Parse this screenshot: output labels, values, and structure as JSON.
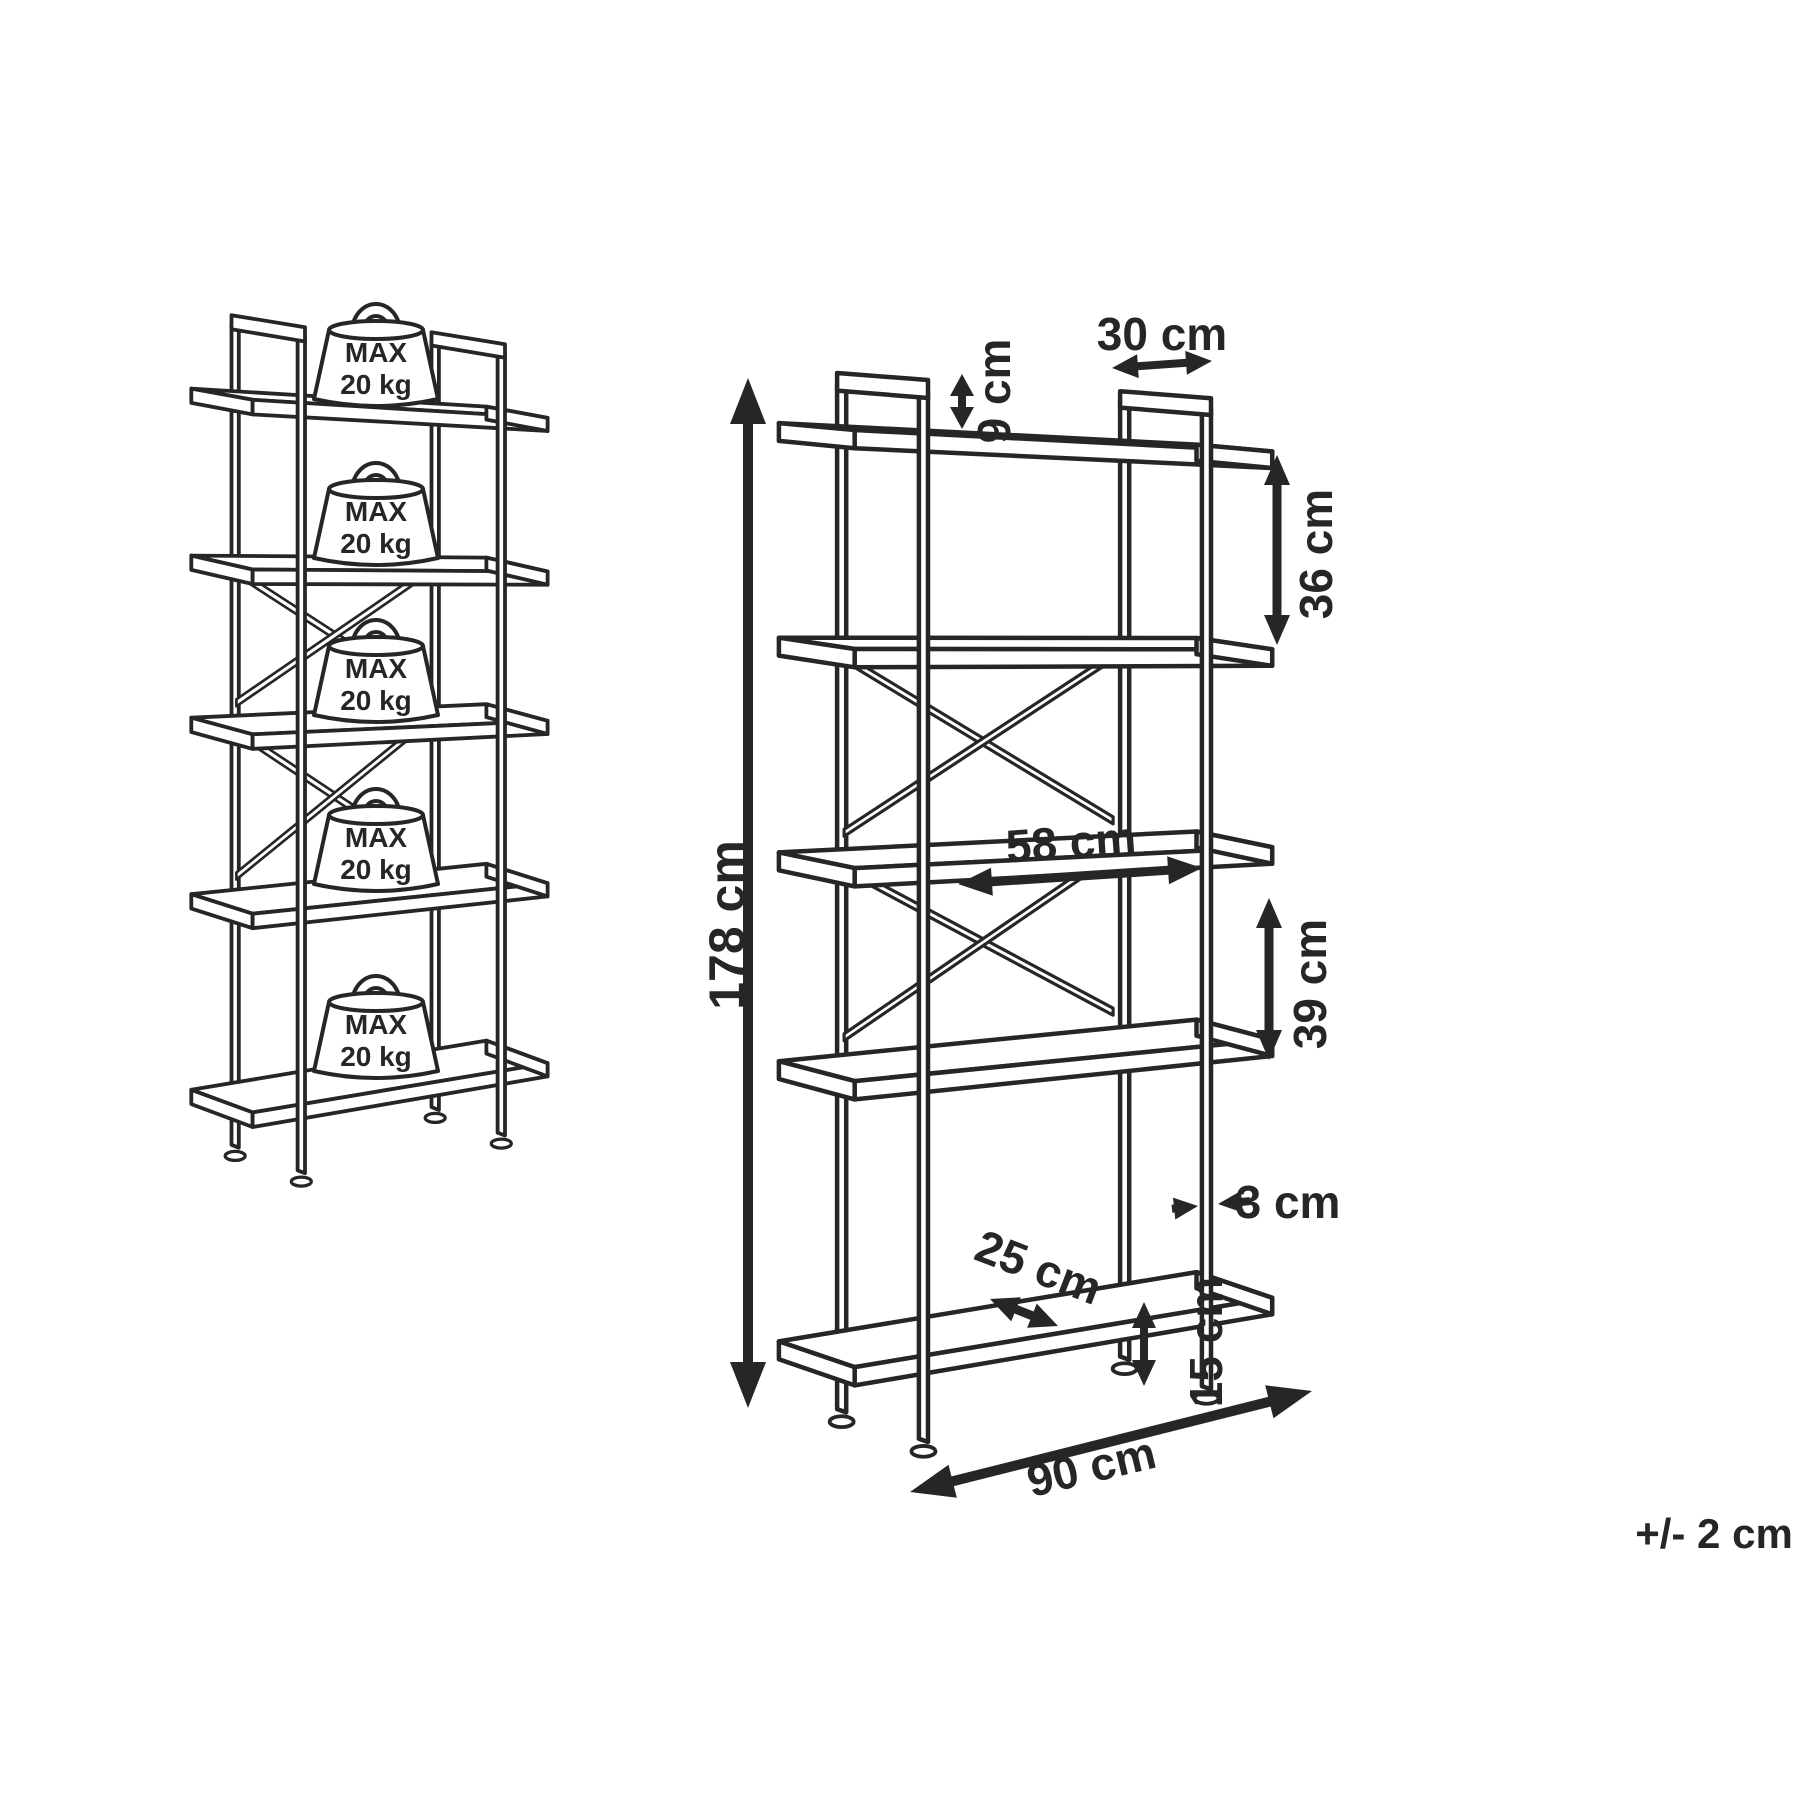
{
  "diagram": {
    "load_figure": {
      "shelf_count": 5,
      "weight_label_line1": "MAX",
      "weight_label_line2": "20 kg"
    },
    "dimension_figure": {
      "dimensions": {
        "height": "178 cm",
        "top_clearance": "9 cm",
        "frame_depth": "30 cm",
        "upper_shelf_gap": "36 cm",
        "inner_width": "58 cm",
        "lower_shelf_gap": "39 cm",
        "frame_thickness": "3 cm",
        "shelf_depth": "25 cm",
        "bottom_clearance": "15 cm",
        "total_width": "90 cm"
      }
    },
    "tolerance_note": "+/- 2 cm",
    "colors": {
      "line": "#262626",
      "background": "#ffffff"
    }
  }
}
